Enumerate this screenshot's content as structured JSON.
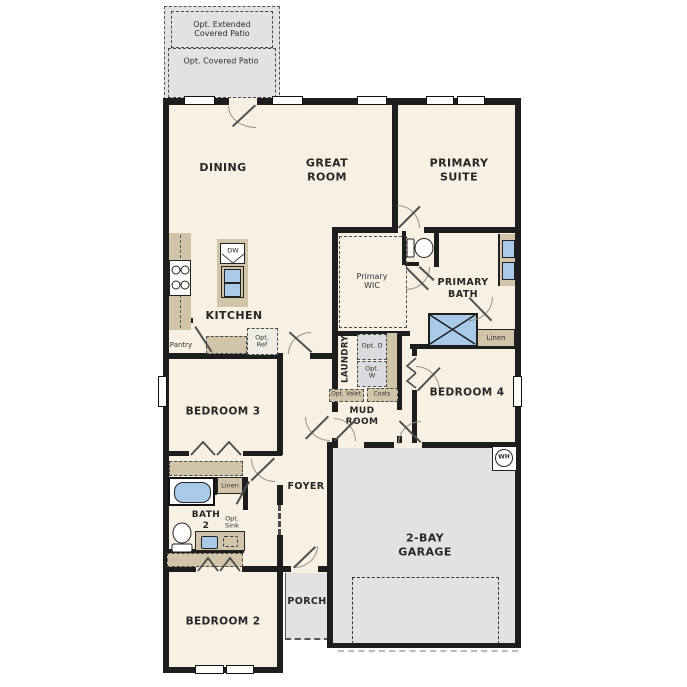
{
  "colors": {
    "floor": "#f8f0e3",
    "wall": "#1d1d1d",
    "counter_tan": "#d2c4a8",
    "fixture_blue": "#a9c9e9",
    "exterior_gray": "#e3e2e0",
    "background": "#ffffff"
  },
  "patio": {
    "extended": "Opt. Extended Covered Patio",
    "covered": "Opt. Covered Patio"
  },
  "rooms": {
    "dining": "DINING",
    "great_room": "GREAT ROOM",
    "primary_suite": "PRIMARY SUITE",
    "kitchen": "KITCHEN",
    "primary_wic": "Primary WIC",
    "primary_bath": "PRIMARY BATH",
    "laundry": "LAUNDRY",
    "mud_room": "MUD ROOM",
    "bedroom4": "BEDROOM 4",
    "bedroom3": "BEDROOM 3",
    "bath2": "BATH 2",
    "foyer": "FOYER",
    "porch": "PORCH",
    "garage": "2-BAY GARAGE",
    "bedroom2": "BEDROOM 2"
  },
  "features": {
    "pantry": "Pantry",
    "opt_ref": "Opt. Ref",
    "dishwasher": "DW",
    "linen_primary": "Linen",
    "opt_dryer": "Opt. D",
    "opt_washer": "Opt. W",
    "opt_valet": "Opt. Valet",
    "coats": "Coats",
    "linen_bath": "Linen",
    "opt_sink": "Opt. Sink",
    "water_heater": "WH"
  }
}
